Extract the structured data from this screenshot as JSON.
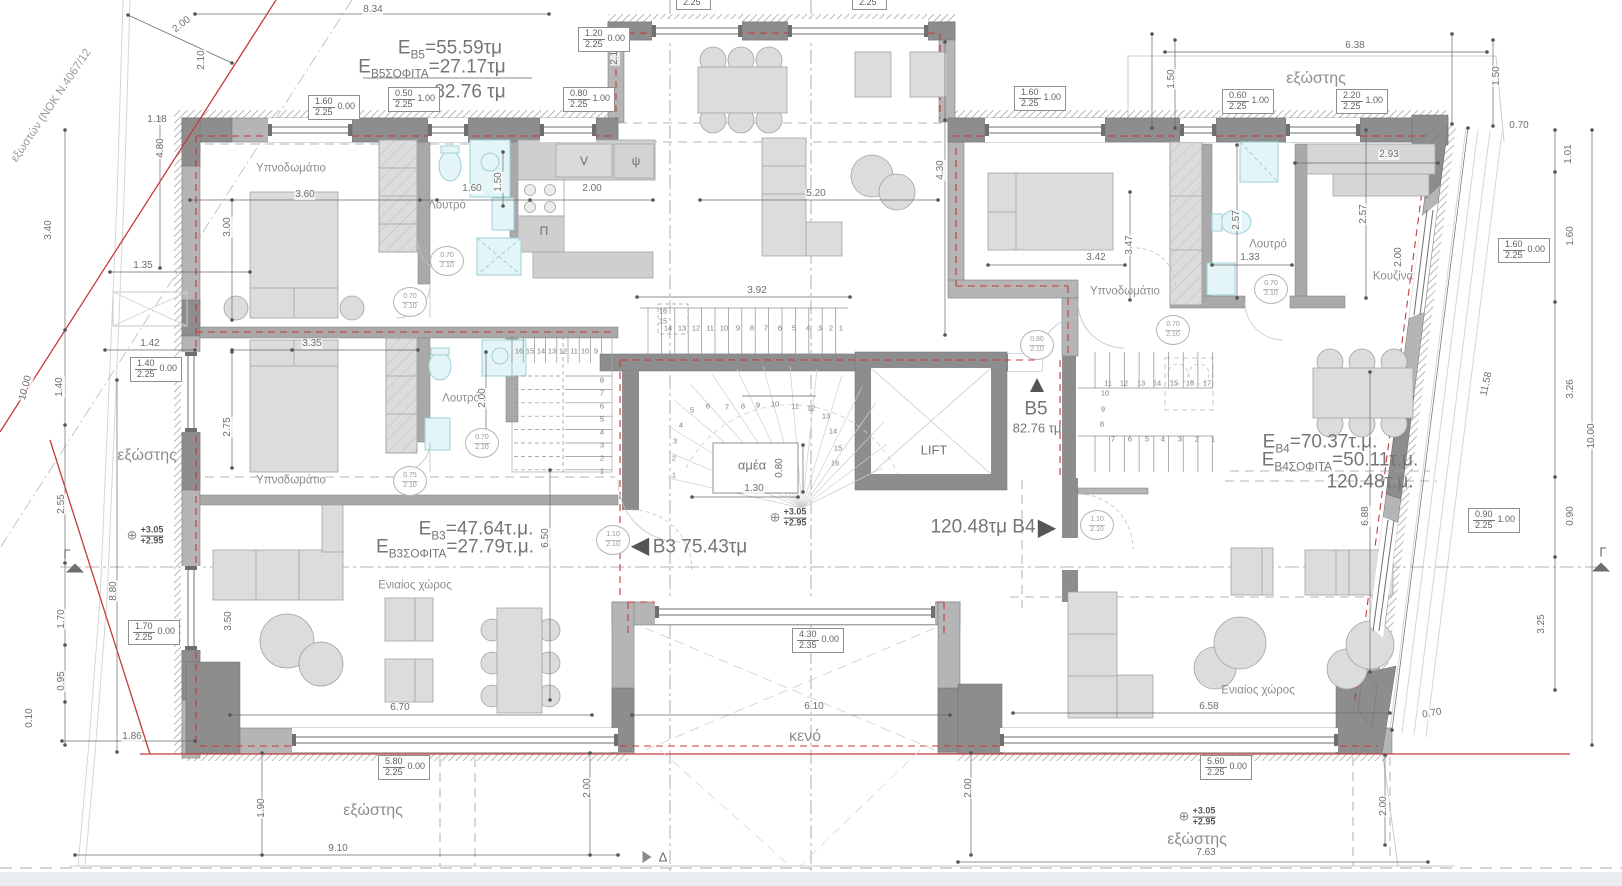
{
  "colors": {
    "wall": "#b5b5b5",
    "wall_dark": "#8d8d8d",
    "furniture": "#dcdcdc",
    "fixture": "#e4f5f7",
    "red_line": "#c43b3b",
    "dim_line": "#6a6a6a",
    "text": "#8a8a8a"
  },
  "apartments": {
    "B5": {
      "area": "55.59τμ",
      "attic": "27.17τμ",
      "total": "82.76 τμ"
    },
    "B4": {
      "area": "70.37τ.μ.",
      "attic": "50.11τ.μ.",
      "total": "120.48τ.μ."
    },
    "B3": {
      "area": "47.64τ.μ.",
      "attic": "27.79τ.μ.",
      "total": "75.43τμ"
    }
  },
  "labels": [
    {
      "t": "εξωστών (ΝΟΚ Ν.4067/12",
      "x": 52,
      "y": 106,
      "r": -56,
      "c": "note"
    },
    {
      "pre": "E",
      "sub": "B5",
      "post": "=55.59τμ",
      "x": 450,
      "y": 50,
      "c": "big"
    },
    {
      "pre": "E",
      "sub": "B5ΣΟΦΙΤΑ",
      "post": "=27.17τμ",
      "x": 432,
      "y": 69,
      "c": "big"
    },
    {
      "t": "82.76 τμ",
      "x": 470,
      "y": 92,
      "c": "big"
    },
    {
      "pre": "E",
      "sub": "B4",
      "post": "=70.37τ.μ.",
      "x": 1320,
      "y": 444,
      "c": "big"
    },
    {
      "pre": "E",
      "sub": "B4ΣΟΦΙΤΑ",
      "post": "=50.11τ.μ.",
      "x": 1340,
      "y": 462,
      "c": "big"
    },
    {
      "t": "120.48τ.μ.",
      "x": 1370,
      "y": 482,
      "c": "big"
    },
    {
      "pre": "E",
      "sub": "B3",
      "post": "=47.64τ.μ.",
      "x": 476,
      "y": 531,
      "c": "big"
    },
    {
      "pre": "E",
      "sub": "B3ΣΟΦΙΤΑ",
      "post": "=27.79τ.μ.",
      "x": 455,
      "y": 549,
      "c": "big"
    },
    {
      "t": "B3 75.43τμ",
      "x": 700,
      "y": 547,
      "c": "big"
    },
    {
      "t": "120.48τμ B4",
      "x": 983,
      "y": 527,
      "c": "big"
    },
    {
      "t": "B5",
      "x": 1036,
      "y": 409,
      "c": "big"
    },
    {
      "t": "82.76 τμ",
      "x": 1037,
      "y": 428,
      "c": "med"
    },
    {
      "t": "▲",
      "x": 1037,
      "y": 385,
      "c": "tri"
    },
    {
      "t": "◀",
      "x": 640,
      "y": 546,
      "c": "tri"
    },
    {
      "t": "▶",
      "x": 1047,
      "y": 528,
      "c": "tri"
    },
    {
      "t": "Υπνοδωμάτιο",
      "x": 291,
      "y": 169,
      "c": "room"
    },
    {
      "t": "Υπνοδωμάτιο",
      "x": 291,
      "y": 481,
      "c": "room"
    },
    {
      "t": "Υπνοδωμάτιο",
      "x": 1125,
      "y": 292,
      "c": "room"
    },
    {
      "t": "Λουτρό",
      "x": 447,
      "y": 206,
      "c": "room"
    },
    {
      "t": "Λουτρό",
      "x": 461,
      "y": 399,
      "c": "room"
    },
    {
      "t": "Λουτρό",
      "x": 1268,
      "y": 245,
      "c": "room"
    },
    {
      "t": "Κουζίνα",
      "x": 1393,
      "y": 277,
      "c": "room"
    },
    {
      "t": "Ενιαίος χώρος",
      "x": 415,
      "y": 586,
      "c": "room"
    },
    {
      "t": "Ενιαίος χώρος",
      "x": 1258,
      "y": 691,
      "c": "room"
    },
    {
      "t": "εξώστης",
      "x": 1316,
      "y": 79,
      "c": "balc"
    },
    {
      "t": "εξώστης",
      "x": 147,
      "y": 456,
      "c": "balc"
    },
    {
      "t": "εξώστης",
      "x": 373,
      "y": 811,
      "c": "balc"
    },
    {
      "t": "εξώστης",
      "x": 1197,
      "y": 840,
      "c": "balc"
    },
    {
      "t": "κενό",
      "x": 805,
      "y": 737,
      "c": "balc"
    },
    {
      "t": "LIFT",
      "x": 934,
      "y": 450,
      "c": "med"
    },
    {
      "t": "αμέα",
      "x": 752,
      "y": 465,
      "c": "med"
    },
    {
      "t": "V",
      "x": 584,
      "y": 161,
      "c": "fix"
    },
    {
      "t": "ψ",
      "x": 636,
      "y": 161,
      "c": "fix"
    },
    {
      "t": "Π",
      "x": 544,
      "y": 231,
      "c": "fix"
    },
    {
      "t": "8.34",
      "x": 373,
      "y": 10,
      "c": "dim"
    },
    {
      "t": "2.00",
      "x": 182,
      "y": 25,
      "r": -38,
      "c": "dim"
    },
    {
      "t": "2.10",
      "x": 202,
      "y": 60,
      "r": -90,
      "c": "dim"
    },
    {
      "t": "2.10",
      "x": 615,
      "y": 55,
      "r": -90,
      "c": "dim"
    },
    {
      "t": "1.18",
      "x": 157,
      "y": 120,
      "c": "dim"
    },
    {
      "t": "4.80",
      "x": 161,
      "y": 148,
      "r": -90,
      "c": "dim"
    },
    {
      "t": "3.40",
      "x": 49,
      "y": 230,
      "r": -90,
      "c": "dim"
    },
    {
      "t": "1.35",
      "x": 143,
      "y": 266,
      "c": "dim"
    },
    {
      "t": "1.42",
      "x": 150,
      "y": 344,
      "c": "dim"
    },
    {
      "t": "1.40",
      "x": 60,
      "y": 387,
      "r": -90,
      "c": "dim"
    },
    {
      "t": "10.00",
      "x": 26,
      "y": 388,
      "r": -75,
      "c": "dim"
    },
    {
      "t": "2.55",
      "x": 62,
      "y": 504,
      "r": -90,
      "c": "dim"
    },
    {
      "t": "1.70",
      "x": 62,
      "y": 619,
      "r": -90,
      "c": "dim"
    },
    {
      "t": "0.95",
      "x": 62,
      "y": 681,
      "r": -90,
      "c": "dim"
    },
    {
      "t": "0.10",
      "x": 30,
      "y": 718,
      "r": -90,
      "c": "dim"
    },
    {
      "t": "8.80",
      "x": 114,
      "y": 591,
      "r": -90,
      "c": "dim"
    },
    {
      "t": "1.86",
      "x": 132,
      "y": 737,
      "c": "dim"
    },
    {
      "t": "1.90",
      "x": 262,
      "y": 808,
      "r": -90,
      "c": "dim"
    },
    {
      "t": "9.10",
      "x": 338,
      "y": 849,
      "c": "dim"
    },
    {
      "t": "3.60",
      "x": 305,
      "y": 195,
      "c": "dim"
    },
    {
      "t": "3.00",
      "x": 228,
      "y": 227,
      "r": -90,
      "c": "dim"
    },
    {
      "t": "1.60",
      "x": 472,
      "y": 189,
      "c": "dim"
    },
    {
      "t": "1.50",
      "x": 499,
      "y": 182,
      "r": -90,
      "c": "dim"
    },
    {
      "t": "2.00",
      "x": 592,
      "y": 189,
      "c": "dim"
    },
    {
      "t": "5.20",
      "x": 816,
      "y": 194,
      "c": "dim"
    },
    {
      "t": "3.35",
      "x": 312,
      "y": 344,
      "c": "dim"
    },
    {
      "t": "2.75",
      "x": 228,
      "y": 427,
      "r": -90,
      "c": "dim"
    },
    {
      "t": "2.00",
      "x": 483,
      "y": 398,
      "r": -90,
      "c": "dim"
    },
    {
      "t": "3.50",
      "x": 229,
      "y": 621,
      "r": -90,
      "c": "dim"
    },
    {
      "t": "6.70",
      "x": 400,
      "y": 708,
      "c": "dim"
    },
    {
      "t": "6.50",
      "x": 546,
      "y": 538,
      "r": -90,
      "c": "dim"
    },
    {
      "t": "3.92",
      "x": 757,
      "y": 291,
      "c": "dim"
    },
    {
      "t": "4.30",
      "x": 941,
      "y": 170,
      "r": -90,
      "c": "dim"
    },
    {
      "t": "6.10",
      "x": 814,
      "y": 707,
      "c": "dim"
    },
    {
      "t": "2.00",
      "x": 588,
      "y": 788,
      "r": -90,
      "c": "dim"
    },
    {
      "t": "2.00",
      "x": 969,
      "y": 788,
      "r": -90,
      "c": "dim"
    },
    {
      "t": "1.30",
      "x": 754,
      "y": 489,
      "c": "dim"
    },
    {
      "t": "0.80",
      "x": 780,
      "y": 468,
      "r": -90,
      "c": "dim"
    },
    {
      "t": "3.42",
      "x": 1096,
      "y": 258,
      "c": "dim"
    },
    {
      "t": "3.47",
      "x": 1130,
      "y": 245,
      "r": -90,
      "c": "dim"
    },
    {
      "t": "2.57",
      "x": 1237,
      "y": 220,
      "r": -90,
      "c": "dim"
    },
    {
      "t": "2.57",
      "x": 1364,
      "y": 214,
      "r": -90,
      "c": "dim"
    },
    {
      "t": "1.33",
      "x": 1250,
      "y": 258,
      "c": "dim"
    },
    {
      "t": "2.00",
      "x": 1399,
      "y": 257,
      "r": -90,
      "c": "dim"
    },
    {
      "t": "2.93",
      "x": 1389,
      "y": 155,
      "c": "dim"
    },
    {
      "t": "6.88",
      "x": 1366,
      "y": 516,
      "r": -90,
      "c": "dim"
    },
    {
      "t": "6.58",
      "x": 1209,
      "y": 707,
      "c": "dim"
    },
    {
      "t": "7.63",
      "x": 1206,
      "y": 853,
      "c": "dim"
    },
    {
      "t": "2.00",
      "x": 1384,
      "y": 806,
      "r": -90,
      "c": "dim"
    },
    {
      "t": "0.70",
      "x": 1432,
      "y": 714,
      "r": -10,
      "c": "dim"
    },
    {
      "t": "6.38",
      "x": 1355,
      "y": 46,
      "c": "dim"
    },
    {
      "t": "1.50",
      "x": 1172,
      "y": 79,
      "r": -90,
      "c": "dim"
    },
    {
      "t": "1.50",
      "x": 1497,
      "y": 76,
      "r": -90,
      "c": "dim"
    },
    {
      "t": "0.70",
      "x": 1519,
      "y": 126,
      "c": "dim"
    },
    {
      "t": "1.01",
      "x": 1569,
      "y": 154,
      "r": -90,
      "c": "dim"
    },
    {
      "t": "1.60",
      "x": 1571,
      "y": 236,
      "r": -90,
      "c": "dim"
    },
    {
      "t": "3.26",
      "x": 1571,
      "y": 389,
      "r": -90,
      "c": "dim"
    },
    {
      "t": "10.00",
      "x": 1592,
      "y": 436,
      "r": -90,
      "c": "dim"
    },
    {
      "t": "0.90",
      "x": 1571,
      "y": 516,
      "r": -90,
      "c": "dim"
    },
    {
      "t": "3.25",
      "x": 1542,
      "y": 624,
      "r": -90,
      "c": "dim"
    },
    {
      "t": "11.58",
      "x": 1487,
      "y": 384,
      "r": -78,
      "c": "dim"
    }
  ],
  "window_tags": [
    {
      "w": "1.60",
      "h": "2.25",
      "s": "0.00",
      "x": 308,
      "y": 95
    },
    {
      "w": "0.50",
      "h": "2.25",
      "s": "1.00",
      "x": 388,
      "y": 87
    },
    {
      "w": "0.80",
      "h": "2.25",
      "s": "1.00",
      "x": 563,
      "y": 87
    },
    {
      "w": "1.20",
      "h": "2.25",
      "s": "0.00",
      "x": 578,
      "y": 27
    },
    {
      "w": "0.50",
      "h": "2.25",
      "s": "",
      "x": 676,
      "y": -15
    },
    {
      "w": "0.50",
      "h": "2.25",
      "s": "",
      "x": 852,
      "y": -15
    },
    {
      "w": "1.60",
      "h": "2.25",
      "s": "1.00",
      "x": 1014,
      "y": 86
    },
    {
      "w": "0.60",
      "h": "2.25",
      "s": "1.00",
      "x": 1222,
      "y": 89
    },
    {
      "w": "2.20",
      "h": "2.25",
      "s": "1.00",
      "x": 1336,
      "y": 89
    },
    {
      "w": "1.40",
      "h": "2.25",
      "s": "0.00",
      "x": 130,
      "y": 357
    },
    {
      "w": "1.70",
      "h": "2.25",
      "s": "0.00",
      "x": 128,
      "y": 620
    },
    {
      "w": "5.80",
      "h": "2.25",
      "s": "0.00",
      "x": 378,
      "y": 755
    },
    {
      "w": "5.60",
      "h": "2.25",
      "s": "0.00",
      "x": 1200,
      "y": 755
    },
    {
      "w": "4.30",
      "h": "2.35",
      "s": "0.00",
      "x": 792,
      "y": 628
    },
    {
      "w": "1.60",
      "h": "2.25",
      "s": "0.00",
      "x": 1498,
      "y": 238
    },
    {
      "w": "0.90",
      "h": "2.25",
      "s": "1.00",
      "x": 1468,
      "y": 508
    }
  ],
  "door_tags": [
    {
      "w": "0.70",
      "h": "2.10",
      "x": 447,
      "y": 261
    },
    {
      "w": "0.70",
      "h": "2.10",
      "x": 410,
      "y": 302
    },
    {
      "w": "0.70",
      "h": "2.10",
      "x": 482,
      "y": 443
    },
    {
      "w": "0.75",
      "h": "2.10",
      "x": 410,
      "y": 481
    },
    {
      "w": "0.86",
      "h": "2.10",
      "x": 1037,
      "y": 345
    },
    {
      "w": "1.10",
      "h": "2.10",
      "x": 613,
      "y": 540
    },
    {
      "w": "1.10",
      "h": "2.10",
      "x": 1097,
      "y": 525
    },
    {
      "w": "0.70",
      "h": "2.10",
      "x": 1271,
      "y": 289
    },
    {
      "w": "0.70",
      "h": "2.10",
      "x": 1173,
      "y": 330
    }
  ],
  "level_markers": [
    {
      "a": "+3.05",
      "b": "+2.95",
      "x": 145,
      "y": 536
    },
    {
      "a": "+3.05",
      "b": "+2.95",
      "x": 788,
      "y": 518
    },
    {
      "a": "+3.05",
      "b": "+2.95",
      "x": 1197,
      "y": 817
    }
  ],
  "section_markers": [
    {
      "label": "Γ",
      "x": 67,
      "y": 554,
      "tx": 75,
      "ty": 568,
      "dir": "up"
    },
    {
      "label": "Γ",
      "x": 1603,
      "y": 552,
      "tx": 1601,
      "ty": 567,
      "dir": "up"
    },
    {
      "label": "Δ",
      "x": 663,
      "y": 857,
      "tx": 647,
      "ty": 857,
      "dir": "right"
    }
  ],
  "stairs": {
    "run_top": [
      "16",
      "15",
      "14",
      "13",
      "12",
      "11",
      "10",
      "9",
      "8",
      "7",
      "6",
      "5",
      "4",
      "3",
      "2",
      "1"
    ],
    "winder": [
      "1",
      "2",
      "3",
      "4",
      "5",
      "6",
      "7",
      "8",
      "9",
      "10",
      "11",
      "12",
      "13",
      "14",
      "15",
      "16"
    ],
    "attic_b5": [
      "16",
      "15",
      "14",
      "13",
      "12",
      "11",
      "10",
      "9",
      "8",
      "7",
      "6",
      "5",
      "4",
      "3",
      "2",
      "1"
    ],
    "b4_top": [
      "11",
      "12",
      "13",
      "14",
      "15",
      "16",
      "17"
    ],
    "b4_left": [
      "10",
      "9",
      "8"
    ],
    "b4_bottom": [
      "7",
      "6",
      "5",
      "4",
      "3",
      "2",
      "1"
    ]
  }
}
